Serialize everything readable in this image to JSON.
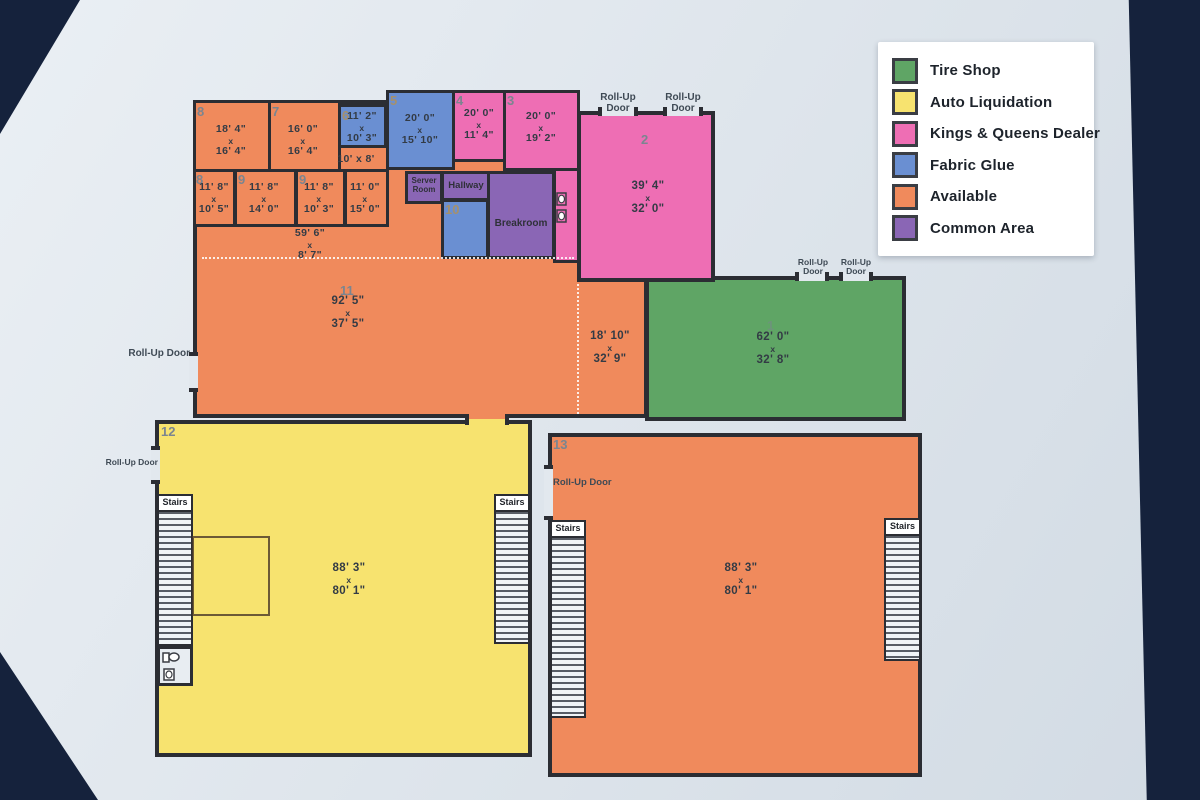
{
  "legend": {
    "items": [
      {
        "label": "Tire Shop",
        "color": "#5fa565"
      },
      {
        "label": "Auto Liquidation",
        "color": "#f7e36f"
      },
      {
        "label": "Kings & Queens Dealer",
        "color": "#ee6eb4"
      },
      {
        "label": "Fabric Glue",
        "color": "#6a8fd2"
      },
      {
        "label": "Available",
        "color": "#f08a5c"
      },
      {
        "label": "Common Area",
        "color": "#8a66b5"
      }
    ]
  },
  "labels": {
    "x": "x",
    "stairs": "Stairs",
    "roll_up": "Roll-Up",
    "door": "Door",
    "roll_up_door": "Roll-Up Door"
  },
  "rooms": {
    "r8a": {
      "number": "8",
      "w": "18' 4\"",
      "h": "16' 4\"",
      "category": "Available"
    },
    "r7": {
      "number": "7",
      "w": "16' 0\"",
      "h": "16' 4\"",
      "category": "Available"
    },
    "r6": {
      "number": "6",
      "w": "11' 2\"",
      "h": "10' 3\"",
      "category": "Fabric Glue"
    },
    "r5": {
      "number": "5",
      "w": "20' 0\"",
      "h": "15' 10\"",
      "category": "Fabric Glue"
    },
    "r4": {
      "number": "4",
      "w": "20' 0\"",
      "h": "11' 4\"",
      "category": "Kings & Queens Dealer"
    },
    "r3": {
      "number": "3",
      "w": "20' 0\"",
      "h": "19' 2\"",
      "category": "Kings & Queens Dealer"
    },
    "r2": {
      "number": "2",
      "w": "39' 4\"",
      "h": "32' 0\"",
      "category": "Kings & Queens Dealer"
    },
    "r8b": {
      "number": "8",
      "w": "11' 8\"",
      "h": "10' 5\"",
      "category": "Available"
    },
    "r9a": {
      "number": "9",
      "w": "11' 8\"",
      "h": "14' 0\"",
      "category": "Available"
    },
    "r9b": {
      "number": "9",
      "w": "11' 8\"",
      "h": "10' 3\"",
      "category": "Available"
    },
    "r11x15": {
      "w": "11' 0\"",
      "h": "15' 0\"",
      "category": "Available"
    },
    "corridor": {
      "w": "59' 6\"",
      "h": "8' 7\"",
      "category": "Available"
    },
    "small_corridor": {
      "dims": "10' x 8'",
      "category": "Available"
    },
    "r11": {
      "number": "11",
      "w": "92' 5\"",
      "h": "37' 5\"",
      "category": "Available"
    },
    "r18": {
      "w": "18' 10\"",
      "h": "32' 9\"",
      "category": "Available"
    },
    "r1": {
      "number": "1",
      "w": "62' 0\"",
      "h": "32' 8\"",
      "category": "Tire Shop"
    },
    "r12": {
      "number": "12",
      "w": "88' 3\"",
      "h": "80' 1\"",
      "category": "Auto Liquidation"
    },
    "r13": {
      "number": "13",
      "w": "88' 3\"",
      "h": "80' 1\"",
      "category": "Available"
    },
    "server": {
      "name": "Server Room",
      "category": "Common Area"
    },
    "hallway": {
      "name": "Hallway",
      "category": "Common Area"
    },
    "breakroom": {
      "name": "Breakroom",
      "category": "Common Area"
    },
    "r10": {
      "number": "10",
      "category": "Fabric Glue"
    }
  }
}
